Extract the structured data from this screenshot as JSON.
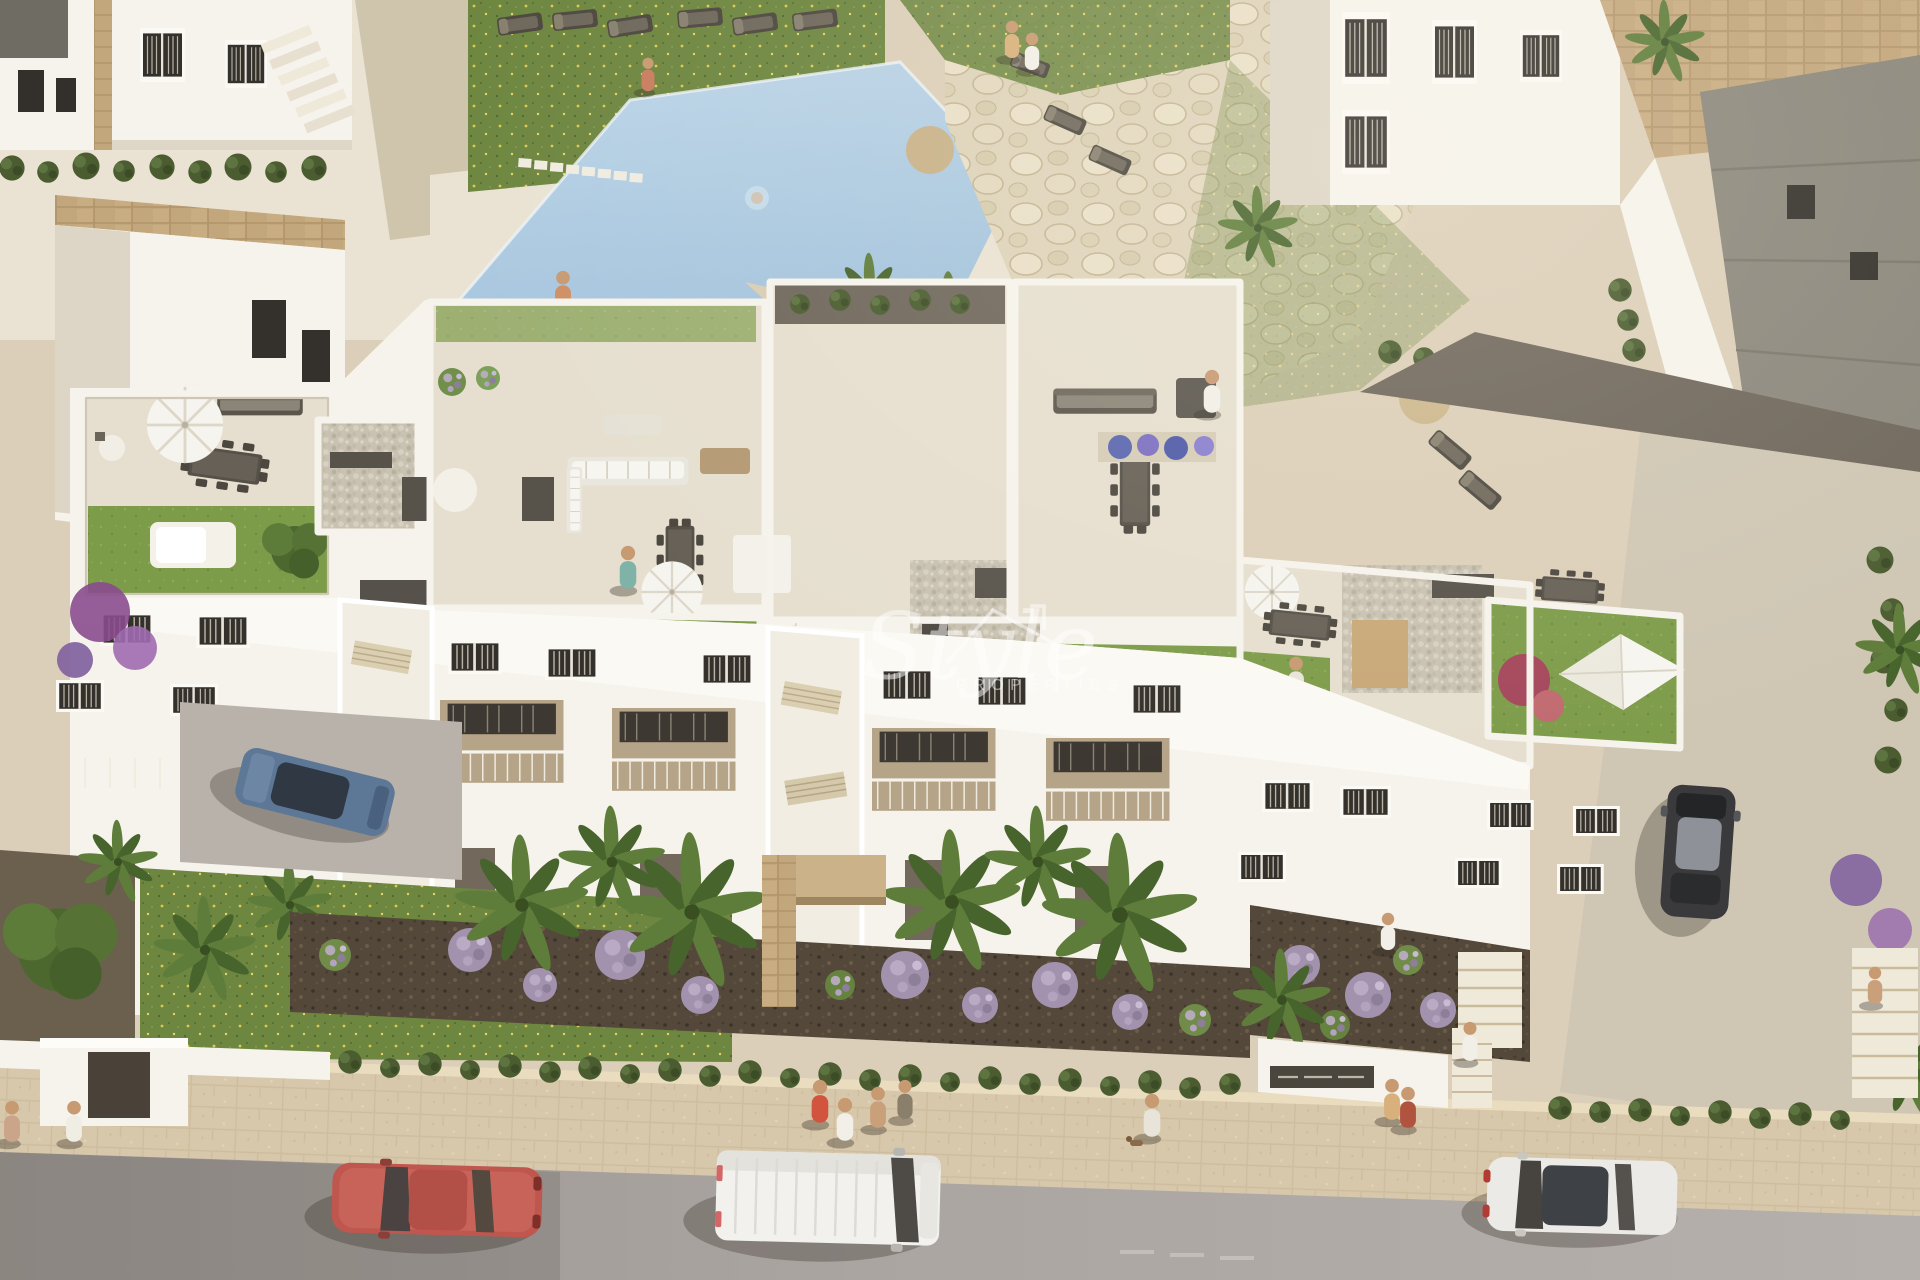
{
  "watermark": {
    "script": "Style",
    "caps": "PROPERTIES"
  },
  "palette": {
    "ground": "#dccfb9",
    "deck": "#eae3d3",
    "street": "#aaa49f",
    "sidewalk": "#d8c8ab",
    "pool": "#bed6e8",
    "poolDeep": "#9cbeda",
    "lawn": "#6d8640",
    "lawnRoof": "#7d9c4a",
    "white": "#f6f3ec",
    "whiteShade": "#ddd5c5",
    "terrace": "#e6dfcf",
    "pebble": "#c9c2b2",
    "soil": "#54483a",
    "hedge": "#4a5c30",
    "palmA": "#5f7d3a",
    "palmB": "#47642c",
    "lavender": "#a392ae",
    "boug": "#9a5fae",
    "rock": "#ded3ba",
    "stone": "#c2a67c",
    "furn": "#57524a",
    "carRed": "#c0574e",
    "carWhite": "#f2f1ee",
    "carSilver": "#ebeae6",
    "carDark": "#3a3a3d",
    "carBlue": "#5d7796"
  }
}
